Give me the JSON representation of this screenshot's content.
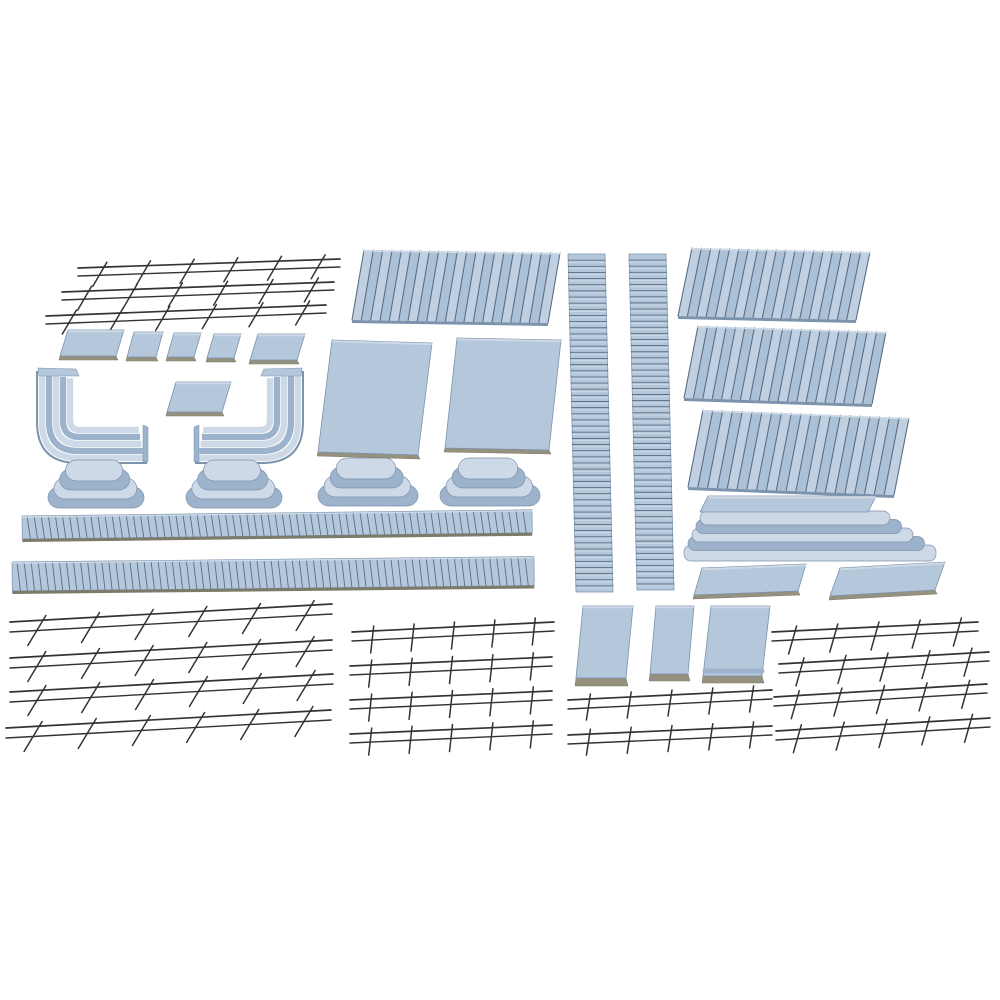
{
  "image": {
    "description": "Model railway platform kit parts: light blue plastic platform tiles, decks, stepped end ramps, corner ramps, corrugated edge strips, slat panels and dark wire railings laid out on a white background",
    "background": "#ffffff",
    "palette": {
      "bg": "#ffffff",
      "plastic_light": "#cdd9e6",
      "plastic_top": "#b4c7db",
      "plastic_mid": "#9db3cb",
      "plastic_dark": "#7b93ad",
      "slat_a": "#c1d0e1",
      "slat_b": "#adc1d6",
      "groove": "#5a6e85",
      "edge_tan": "#95917e",
      "edge_dark": "#7d7a69",
      "wire": "#333333"
    },
    "inventory": {
      "wire_railings": 17,
      "slat_panels": 4,
      "corrugated_strips": 2,
      "ribbed_ramp_strips": 2,
      "stepped_end_ramps": 4,
      "corner_ramps": 2,
      "flat_tiles_and_slabs": 10,
      "wall_panels": 3,
      "platform_edge_stacks": 1
    }
  },
  "parts": [
    {
      "name": "wire-railing-topleft-1",
      "type": "fence",
      "x": 78,
      "y": 268,
      "w": 262,
      "rise": 9,
      "gap": 8,
      "posts": 6,
      "lean": 14,
      "drop": 11
    },
    {
      "name": "wire-railing-topleft-2",
      "type": "fence",
      "x": 62,
      "y": 292,
      "w": 272,
      "rise": 10,
      "gap": 8,
      "posts": 6,
      "lean": 14,
      "drop": 11
    },
    {
      "name": "wire-railing-topleft-3",
      "type": "fence",
      "x": 46,
      "y": 316,
      "w": 280,
      "rise": 11,
      "gap": 8,
      "posts": 6,
      "lean": 14,
      "drop": 11
    },
    {
      "name": "platform-tile-1",
      "type": "tile",
      "x": 60,
      "y": 330,
      "w": 56,
      "h": 26,
      "skew": 8,
      "base": 4
    },
    {
      "name": "platform-tile-2",
      "type": "tile",
      "x": 127,
      "y": 332,
      "w": 29,
      "h": 25,
      "skew": 7,
      "base": 4
    },
    {
      "name": "platform-tile-3",
      "type": "tile",
      "x": 167,
      "y": 333,
      "w": 27,
      "h": 24,
      "skew": 7,
      "base": 4
    },
    {
      "name": "platform-tile-4",
      "type": "tile",
      "x": 207,
      "y": 334,
      "w": 27,
      "h": 24,
      "skew": 7,
      "base": 4
    },
    {
      "name": "platform-tile-5",
      "type": "tile",
      "x": 250,
      "y": 334,
      "w": 47,
      "h": 26,
      "skew": 8,
      "base": 4
    },
    {
      "name": "corner-ramp-left",
      "type": "corner",
      "x": 38,
      "y": 368,
      "w": 108,
      "h": 94,
      "mirrored": false
    },
    {
      "name": "platform-tile-center",
      "type": "tile",
      "x": 167,
      "y": 382,
      "w": 55,
      "h": 30,
      "skew": 9,
      "base": 4
    },
    {
      "name": "corner-ramp-right",
      "type": "corner",
      "x": 196,
      "y": 368,
      "w": 106,
      "h": 94,
      "mirrored": true
    },
    {
      "name": "stepped-end-ramp-1",
      "type": "oval",
      "x": 48,
      "y": 460,
      "w": 96,
      "h": 48
    },
    {
      "name": "stepped-end-ramp-2",
      "type": "oval",
      "x": 186,
      "y": 460,
      "w": 96,
      "h": 48
    },
    {
      "name": "stepped-end-ramp-3",
      "type": "oval",
      "x": 318,
      "y": 458,
      "w": 100,
      "h": 50
    },
    {
      "name": "stepped-end-ramp-4",
      "type": "oval",
      "x": 440,
      "y": 458,
      "w": 100,
      "h": 50
    },
    {
      "name": "corrugated-strip-1",
      "type": "corr",
      "x": 22,
      "y": 516,
      "w": 510,
      "h": 23,
      "ribs": 72,
      "angle": -0.7
    },
    {
      "name": "corrugated-strip-2",
      "type": "corr",
      "x": 12,
      "y": 562,
      "w": 522,
      "h": 29,
      "ribs": 74,
      "angle": -0.6
    },
    {
      "name": "wire-railing-bottomleft-1",
      "type": "fence",
      "x": 10,
      "y": 622,
      "w": 322,
      "rise": 18,
      "gap": 10,
      "posts": 6,
      "lean": 18,
      "drop": 15
    },
    {
      "name": "wire-railing-bottomleft-2",
      "type": "fence",
      "x": 10,
      "y": 658,
      "w": 322,
      "rise": 18,
      "gap": 10,
      "posts": 6,
      "lean": 18,
      "drop": 15
    },
    {
      "name": "wire-railing-bottomleft-3",
      "type": "fence",
      "x": 10,
      "y": 692,
      "w": 323,
      "rise": 18,
      "gap": 10,
      "posts": 6,
      "lean": 18,
      "drop": 15
    },
    {
      "name": "wire-railing-bottomleft-4",
      "type": "fence",
      "x": 6,
      "y": 728,
      "w": 325,
      "rise": 18,
      "gap": 10,
      "posts": 6,
      "lean": 18,
      "drop": 15
    },
    {
      "name": "slat-panel-center",
      "type": "slats",
      "x": 352,
      "y": 250,
      "w": 196,
      "h": 70,
      "slats": 21,
      "skew": 12,
      "tilt": 3
    },
    {
      "name": "platform-deck-1",
      "type": "tile",
      "x": 318,
      "y": 340,
      "w": 100,
      "h": 112,
      "skew": 14,
      "tilt": 3,
      "base": 4
    },
    {
      "name": "platform-deck-2",
      "type": "tile",
      "x": 445,
      "y": 338,
      "w": 104,
      "h": 110,
      "skew": 12,
      "tilt": 2,
      "base": 4
    },
    {
      "name": "ribbed-ramp-strip-1",
      "type": "ladder",
      "x": 568,
      "y": 254,
      "w": 37,
      "h": 338,
      "lean": 8,
      "rungs": 55
    },
    {
      "name": "ribbed-ramp-strip-2",
      "type": "ladder",
      "x": 629,
      "y": 254,
      "w": 37,
      "h": 336,
      "lean": 8,
      "rungs": 55
    },
    {
      "name": "slat-panel-right-1",
      "type": "slats",
      "x": 678,
      "y": 248,
      "w": 178,
      "h": 68,
      "slats": 19,
      "skew": 14,
      "tilt": 4
    },
    {
      "name": "slat-panel-right-2",
      "type": "slats",
      "x": 684,
      "y": 326,
      "w": 188,
      "h": 72,
      "slats": 20,
      "skew": 14,
      "tilt": 6
    },
    {
      "name": "slat-panel-right-3",
      "type": "slats",
      "x": 688,
      "y": 410,
      "w": 206,
      "h": 77,
      "slats": 21,
      "skew": 15,
      "tilt": 8
    },
    {
      "name": "platform-edge-stack",
      "type": "stack",
      "x": 684,
      "y": 496,
      "w": 252
    },
    {
      "name": "platform-slab-1",
      "type": "tile",
      "x": 694,
      "y": 568,
      "w": 104,
      "h": 27,
      "skew": 8,
      "tilt": -4,
      "base": 4
    },
    {
      "name": "platform-slab-2",
      "type": "tile",
      "x": 830,
      "y": 568,
      "w": 105,
      "h": 28,
      "skew": 10,
      "tilt": -6,
      "base": 4
    },
    {
      "name": "wall-panel-1",
      "type": "tile",
      "x": 576,
      "y": 606,
      "w": 50,
      "h": 72,
      "skew": 7,
      "base": 8
    },
    {
      "name": "wall-panel-2",
      "type": "tile",
      "x": 650,
      "y": 606,
      "w": 38,
      "h": 68,
      "skew": 6,
      "base": 7
    },
    {
      "name": "wall-panel-3",
      "type": "tile",
      "x": 703,
      "y": 606,
      "w": 59,
      "h": 70,
      "skew": 8,
      "base": 7,
      "stripe": true
    },
    {
      "name": "wire-railing-midbottom-1",
      "type": "fence",
      "x": 352,
      "y": 632,
      "w": 202,
      "rise": 10,
      "gap": 9,
      "posts": 5,
      "lean": 3,
      "drop": 13
    },
    {
      "name": "wire-railing-midbottom-2",
      "type": "fence",
      "x": 350,
      "y": 666,
      "w": 202,
      "rise": 9,
      "gap": 9,
      "posts": 5,
      "lean": 3,
      "drop": 13
    },
    {
      "name": "wire-railing-midbottom-3",
      "type": "fence",
      "x": 350,
      "y": 700,
      "w": 202,
      "rise": 9,
      "gap": 9,
      "posts": 5,
      "lean": 3,
      "drop": 13
    },
    {
      "name": "wire-railing-midbottom-4",
      "type": "fence",
      "x": 350,
      "y": 734,
      "w": 202,
      "rise": 9,
      "gap": 9,
      "posts": 5,
      "lean": 3,
      "drop": 13
    },
    {
      "name": "wire-railing-centerbottom-1",
      "type": "fence",
      "x": 568,
      "y": 700,
      "w": 204,
      "rise": 10,
      "gap": 9,
      "posts": 5,
      "lean": 4,
      "drop": 12
    },
    {
      "name": "wire-railing-centerbottom-2",
      "type": "fence",
      "x": 568,
      "y": 735,
      "w": 204,
      "rise": 9,
      "gap": 9,
      "posts": 5,
      "lean": 4,
      "drop": 12
    },
    {
      "name": "wire-railing-right-1",
      "type": "fence",
      "x": 772,
      "y": 632,
      "w": 206,
      "rise": 10,
      "gap": 9,
      "posts": 5,
      "lean": 8,
      "drop": 14
    },
    {
      "name": "wire-railing-right-2",
      "type": "fence",
      "x": 779,
      "y": 664,
      "w": 210,
      "rise": 12,
      "gap": 9,
      "posts": 5,
      "lean": 8,
      "drop": 14
    },
    {
      "name": "wire-railing-right-3",
      "type": "fence",
      "x": 774,
      "y": 697,
      "w": 213,
      "rise": 13,
      "gap": 9,
      "posts": 5,
      "lean": 8,
      "drop": 14
    },
    {
      "name": "wire-railing-right-4",
      "type": "fence",
      "x": 776,
      "y": 731,
      "w": 214,
      "rise": 13,
      "gap": 9,
      "posts": 5,
      "lean": 8,
      "drop": 14
    }
  ]
}
